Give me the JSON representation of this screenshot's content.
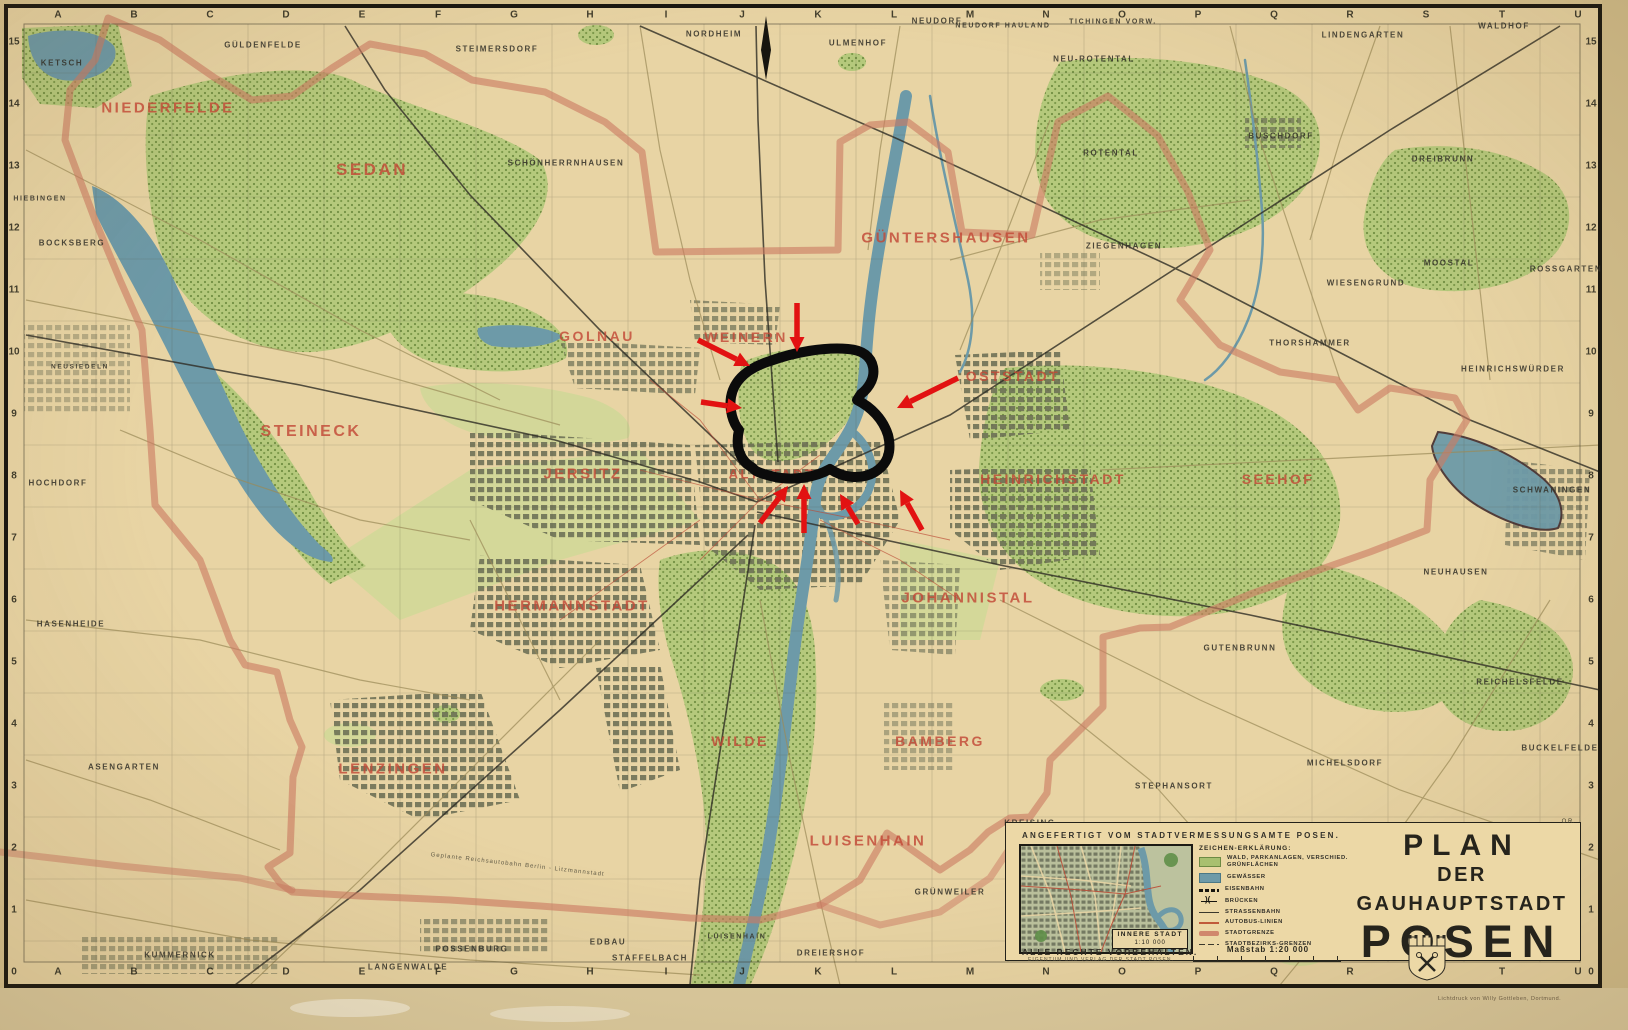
{
  "map": {
    "title_block": {
      "line1": "PLAN",
      "line2": "DER GAUHAUPTSTADT",
      "line3": "POSEN"
    },
    "panel": {
      "credit": "ANGEFERTIGT VOM STADTVERMESSUNGSAMTE POSEN.",
      "rights": "ALLE RECHTE VORBEHALTEN.",
      "rights_sub": "EIGENTUM UND VERLAG DER STADT POSEN.",
      "scale_label": "Maßstab 1:20 000",
      "printer": "Lichtdruck von Willy Gottleben, Dortmund.",
      "initials": "O.R."
    },
    "inset": {
      "label_line1": "INNERE STADT",
      "label_line2": "1:10 000"
    },
    "legend": {
      "title": "ZEICHEN-ERKLÄRUNG:",
      "items": [
        {
          "sym": "green",
          "label": "WALD, PARKANLAGEN, VERSCHIED. GRÜNFLÄCHEN"
        },
        {
          "sym": "blue",
          "label": "GEWÄSSER"
        },
        {
          "sym": "rail",
          "label": "EISENBAHN"
        },
        {
          "sym": "bridge",
          "label": "BRÜCKEN"
        },
        {
          "sym": "tram",
          "label": "STRASSENBAHN"
        },
        {
          "sym": "bus",
          "label": "AUTOBUS-LINIEN"
        },
        {
          "sym": "grenze",
          "label": "STADTGRENZE"
        },
        {
          "sym": "bezirk",
          "label": "STADTBEZIRKS-GRENZEN"
        }
      ]
    },
    "grid": {
      "letters": [
        "A",
        "B",
        "C",
        "D",
        "E",
        "F",
        "G",
        "H",
        "I",
        "J",
        "K",
        "L",
        "M",
        "N",
        "O",
        "P",
        "Q",
        "R",
        "S",
        "T",
        "U"
      ],
      "numbers": [
        "15",
        "14",
        "13",
        "12",
        "11",
        "10",
        "9",
        "8",
        "7",
        "6",
        "5",
        "4",
        "3",
        "2",
        "1",
        "0"
      ]
    },
    "district_labels": [
      {
        "name": "NIEDERFELDE",
        "x": 168,
        "y": 108,
        "fs": 15
      },
      {
        "name": "SEDAN",
        "x": 372,
        "y": 170,
        "fs": 17
      },
      {
        "name": "GOLNAU",
        "x": 597,
        "y": 336,
        "fs": 14
      },
      {
        "name": "WEINERN",
        "x": 746,
        "y": 337,
        "fs": 14
      },
      {
        "name": "GÜNTERSHAUSEN",
        "x": 946,
        "y": 238,
        "fs": 15
      },
      {
        "name": "OSTSTADT",
        "x": 1013,
        "y": 376,
        "fs": 14
      },
      {
        "name": "STEINECK",
        "x": 311,
        "y": 432,
        "fs": 16
      },
      {
        "name": "JERSITZ",
        "x": 583,
        "y": 474,
        "fs": 15
      },
      {
        "name": "ALTSTADT",
        "x": 772,
        "y": 474,
        "fs": 13
      },
      {
        "name": "HEINRICHSTADT",
        "x": 1053,
        "y": 479,
        "fs": 14
      },
      {
        "name": "SEEHOF",
        "x": 1278,
        "y": 479,
        "fs": 14
      },
      {
        "name": "HERMANNSTADT",
        "x": 572,
        "y": 606,
        "fs": 15
      },
      {
        "name": "JOHANNISTAL",
        "x": 968,
        "y": 598,
        "fs": 15
      },
      {
        "name": "WILDE",
        "x": 740,
        "y": 741,
        "fs": 14
      },
      {
        "name": "BAMBERG",
        "x": 940,
        "y": 741,
        "fs": 14
      },
      {
        "name": "LENZINGEN",
        "x": 393,
        "y": 769,
        "fs": 15
      },
      {
        "name": "LUISENHAIN",
        "x": 868,
        "y": 841,
        "fs": 15
      }
    ],
    "place_labels": [
      {
        "name": "KETSCH",
        "x": 62,
        "y": 63
      },
      {
        "name": "GÜLDENFELDE",
        "x": 263,
        "y": 45
      },
      {
        "name": "STEIMERSDORF",
        "x": 497,
        "y": 49
      },
      {
        "name": "SCHÖNHERRNHAUSEN",
        "x": 566,
        "y": 163
      },
      {
        "name": "NORDHEIM",
        "x": 714,
        "y": 34
      },
      {
        "name": "ULMENHOF",
        "x": 858,
        "y": 43
      },
      {
        "name": "NEUDORF",
        "x": 937,
        "y": 21
      },
      {
        "name": "NEUDORF HAULAND",
        "x": 1003,
        "y": 26,
        "fs": 7
      },
      {
        "name": "TICHINGEN VORW.",
        "x": 1113,
        "y": 22,
        "fs": 7
      },
      {
        "name": "NEU-ROTENTAL",
        "x": 1094,
        "y": 59
      },
      {
        "name": "ROTENTAL",
        "x": 1111,
        "y": 153
      },
      {
        "name": "LINDENGARTEN",
        "x": 1363,
        "y": 35
      },
      {
        "name": "WALDHOF",
        "x": 1504,
        "y": 26
      },
      {
        "name": "BUSCHDORF",
        "x": 1281,
        "y": 136
      },
      {
        "name": "DREIBRUNN",
        "x": 1443,
        "y": 159
      },
      {
        "name": "ROSSGARTEN",
        "x": 1566,
        "y": 269
      },
      {
        "name": "MOOSTAL",
        "x": 1449,
        "y": 263
      },
      {
        "name": "WIESENGRUND",
        "x": 1366,
        "y": 283
      },
      {
        "name": "THORSHAMMER",
        "x": 1310,
        "y": 343
      },
      {
        "name": "ZIEGENHAGEN",
        "x": 1124,
        "y": 246
      },
      {
        "name": "HEINRICHSWÜRDER",
        "x": 1513,
        "y": 369
      },
      {
        "name": "HIEBINGEN",
        "x": 40,
        "y": 199,
        "fs": 7
      },
      {
        "name": "BOCKSBERG",
        "x": 72,
        "y": 243
      },
      {
        "name": "NEUSIEDELN",
        "x": 80,
        "y": 367,
        "fs": 6.5
      },
      {
        "name": "HOCHDORF",
        "x": 58,
        "y": 483
      },
      {
        "name": "HASENHEIDE",
        "x": 71,
        "y": 624
      },
      {
        "name": "ASENGARTEN",
        "x": 124,
        "y": 767
      },
      {
        "name": "KUMMERNICK",
        "x": 180,
        "y": 955
      },
      {
        "name": "LANGENWALDE",
        "x": 408,
        "y": 967
      },
      {
        "name": "POSSENBURG",
        "x": 472,
        "y": 949
      },
      {
        "name": "EDBAU",
        "x": 608,
        "y": 942
      },
      {
        "name": "STAFFELBACH",
        "x": 650,
        "y": 958
      },
      {
        "name": "LUISENHAIN",
        "x": 737,
        "y": 937,
        "fs": 7
      },
      {
        "name": "DREIERSHOF",
        "x": 831,
        "y": 953
      },
      {
        "name": "GRÜNWEILER",
        "x": 950,
        "y": 892
      },
      {
        "name": "KREISING",
        "x": 1030,
        "y": 823
      },
      {
        "name": "STEPHANSORT",
        "x": 1174,
        "y": 786
      },
      {
        "name": "MICHELSDORF",
        "x": 1345,
        "y": 763
      },
      {
        "name": "GUTENBRUNN",
        "x": 1240,
        "y": 648
      },
      {
        "name": "REICHELSFELDE",
        "x": 1520,
        "y": 682
      },
      {
        "name": "BUCKELFELDE",
        "x": 1560,
        "y": 748
      },
      {
        "name": "NEUHAUSEN",
        "x": 1456,
        "y": 572
      },
      {
        "name": "SCHWANINGEN",
        "x": 1552,
        "y": 490
      }
    ],
    "autobahn_label": "Geplante Reichsautobahn  Berlin - Litzmannstadt",
    "colors": {
      "paper": "#e8d4a4",
      "forest": "#b5c97c",
      "water": "#6d9aa8",
      "district_red": "#c24936",
      "boundary": "#cc7a63",
      "annotation_red": "#e21212",
      "ink": "#33312a"
    }
  },
  "annotation": {
    "loop_path": "M753,468 C740,461 735,447 739,430 C733,423 729,410 731,397 C734,380 748,368 770,361 C795,352 824,347 848,349 C863,350 871,357 873,367 C875,377 870,387 861,394 L857,400 C871,407 883,419 888,435 C892,451 888,464 875,472 C861,480 843,478 830,469 C816,477 794,481 775,477 C763,474 755,472 753,468 Z",
    "arrows": [
      {
        "x1": 797,
        "y1": 303,
        "x2": 797,
        "y2": 352
      },
      {
        "x1": 698,
        "y1": 340,
        "x2": 750,
        "y2": 366
      },
      {
        "x1": 701,
        "y1": 402,
        "x2": 742,
        "y2": 408
      },
      {
        "x1": 958,
        "y1": 378,
        "x2": 897,
        "y2": 408
      },
      {
        "x1": 760,
        "y1": 523,
        "x2": 788,
        "y2": 486
      },
      {
        "x1": 804,
        "y1": 533,
        "x2": 804,
        "y2": 484
      },
      {
        "x1": 858,
        "y1": 524,
        "x2": 840,
        "y2": 494
      },
      {
        "x1": 922,
        "y1": 530,
        "x2": 900,
        "y2": 490
      }
    ]
  }
}
